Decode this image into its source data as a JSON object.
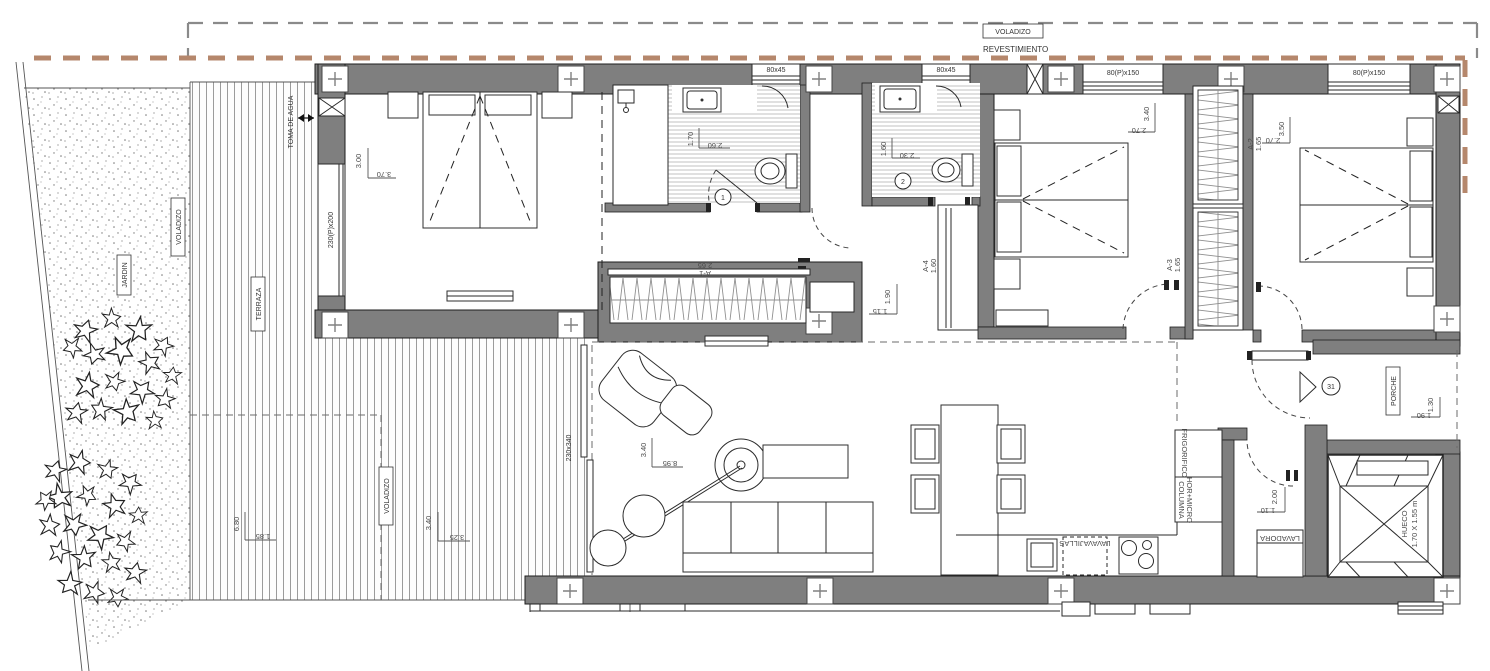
{
  "drawing": {
    "type": "apartment floor plan",
    "unit_number": "31"
  },
  "colors": {
    "wall": "#7f7f7f",
    "revestimiento_dash": "#b5876c",
    "overhang_dash": "#8a8a8a",
    "line": "#1d1d1d"
  },
  "site": {
    "voladizo_top": "VOLADIZO",
    "revestimiento": "REVESTIMIENTO",
    "voladizo_left": "VOLADIZO",
    "jardin": "JARDIN",
    "terraza": "TERRAZA",
    "toma_de_agua": "TOMA DE AGUA",
    "voladizo_terrace": "VOLADIZO"
  },
  "windows": {
    "bath1": "80x45",
    "bath2": "80x45",
    "bedroom2": "80(P)x150",
    "bedroom3": "80(P)x150",
    "bedroom1": "230(P)x200",
    "living": "230x340"
  },
  "rooms": {
    "bedroom1": {
      "d_h": "3.00",
      "d_w": "3.70"
    },
    "bath1": {
      "num": "1",
      "d_h": "1.70",
      "d_w": "2.60"
    },
    "bath2": {
      "num": "2",
      "d_h": "1.60",
      "d_w": "2.30"
    },
    "bedroom2": {
      "d_h": "3.40",
      "d_w": "2.70"
    },
    "bedroom3": {
      "d_h": "3.50",
      "d_w": "2.70"
    },
    "hall": {
      "d_h": "1.90",
      "d_w": "1.15"
    },
    "living": {
      "d_h": "3.40",
      "d_w": "8.95"
    },
    "terrace_a": {
      "d_h": "6.80",
      "d_w": "1.85"
    },
    "terrace_b": {
      "d_h": "3.40",
      "d_w": "3.25"
    },
    "laundry": {
      "label": "LAVADORA",
      "d_h": "2.00",
      "d_w": "1.10"
    },
    "porch": {
      "label": "PORCHE",
      "d_h": "1.30",
      "d_w": "1.90"
    },
    "entry": {
      "unit": "31"
    },
    "hueco": {
      "label": "HUECO",
      "size": "1.70 X 1.55 m"
    }
  },
  "kitchen": {
    "dishwasher": "LAVAVAJILLAS",
    "fridge": "FRIGORIFICO",
    "column_line1": "COLUMNA",
    "column_line2": "HOR+MICRO"
  },
  "wardrobes": {
    "a1": "A-1",
    "a1_w": "2.65",
    "a2": "A-2",
    "a2_w": "1.65",
    "a3": "A-3",
    "a3_w": "1.65",
    "a4": "A-4",
    "a4_w": "1.60"
  }
}
